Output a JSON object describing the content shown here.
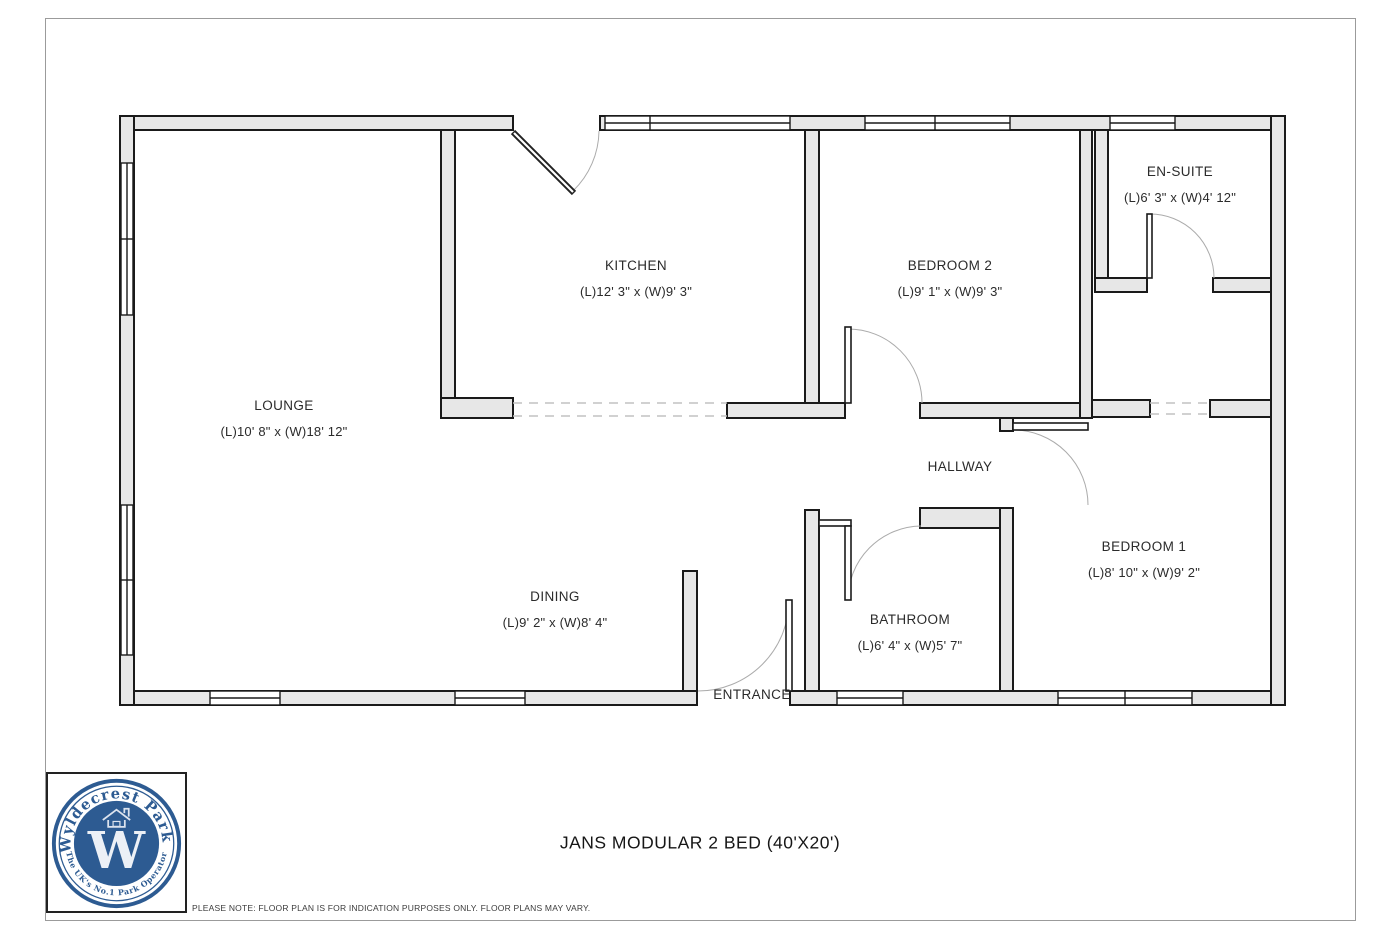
{
  "page": {
    "title": "JANS MODULAR 2 BED (40'X20')",
    "disclaimer": "PLEASE NOTE: FLOOR PLAN IS FOR INDICATION PURPOSES ONLY. FLOOR PLANS MAY VARY."
  },
  "logo": {
    "brand_top": "Wyldecrest Parks",
    "brand_bottom": "The UK's No.1 Park Operator",
    "monogram": "W",
    "blue": "#2d5b92"
  },
  "rooms": [
    {
      "name": "LOUNGE",
      "dims": "(L)10' 8\" x (W)18' 12\""
    },
    {
      "name": "KITCHEN",
      "dims": "(L)12' 3\" x (W)9' 3\""
    },
    {
      "name": "BEDROOM 2",
      "dims": "(L)9' 1\" x (W)9' 3\""
    },
    {
      "name": "EN-SUITE",
      "dims": "(L)6' 3\" x (W)4' 12\""
    },
    {
      "name": "HALLWAY",
      "dims": ""
    },
    {
      "name": "BEDROOM 1",
      "dims": "(L)8' 10\" x (W)9' 2\""
    },
    {
      "name": "DINING",
      "dims": "(L)9' 2\" x (W)8' 4\""
    },
    {
      "name": "BATHROOM",
      "dims": "(L)6' 4\" x (W)5' 7\""
    },
    {
      "name": "ENTRANCE",
      "dims": ""
    }
  ],
  "colors": {
    "wall_fill": "#e7e7e7",
    "wall_stroke": "#1a1a1a",
    "dash": "#c2c2c2",
    "door_arc": "#ababab"
  }
}
